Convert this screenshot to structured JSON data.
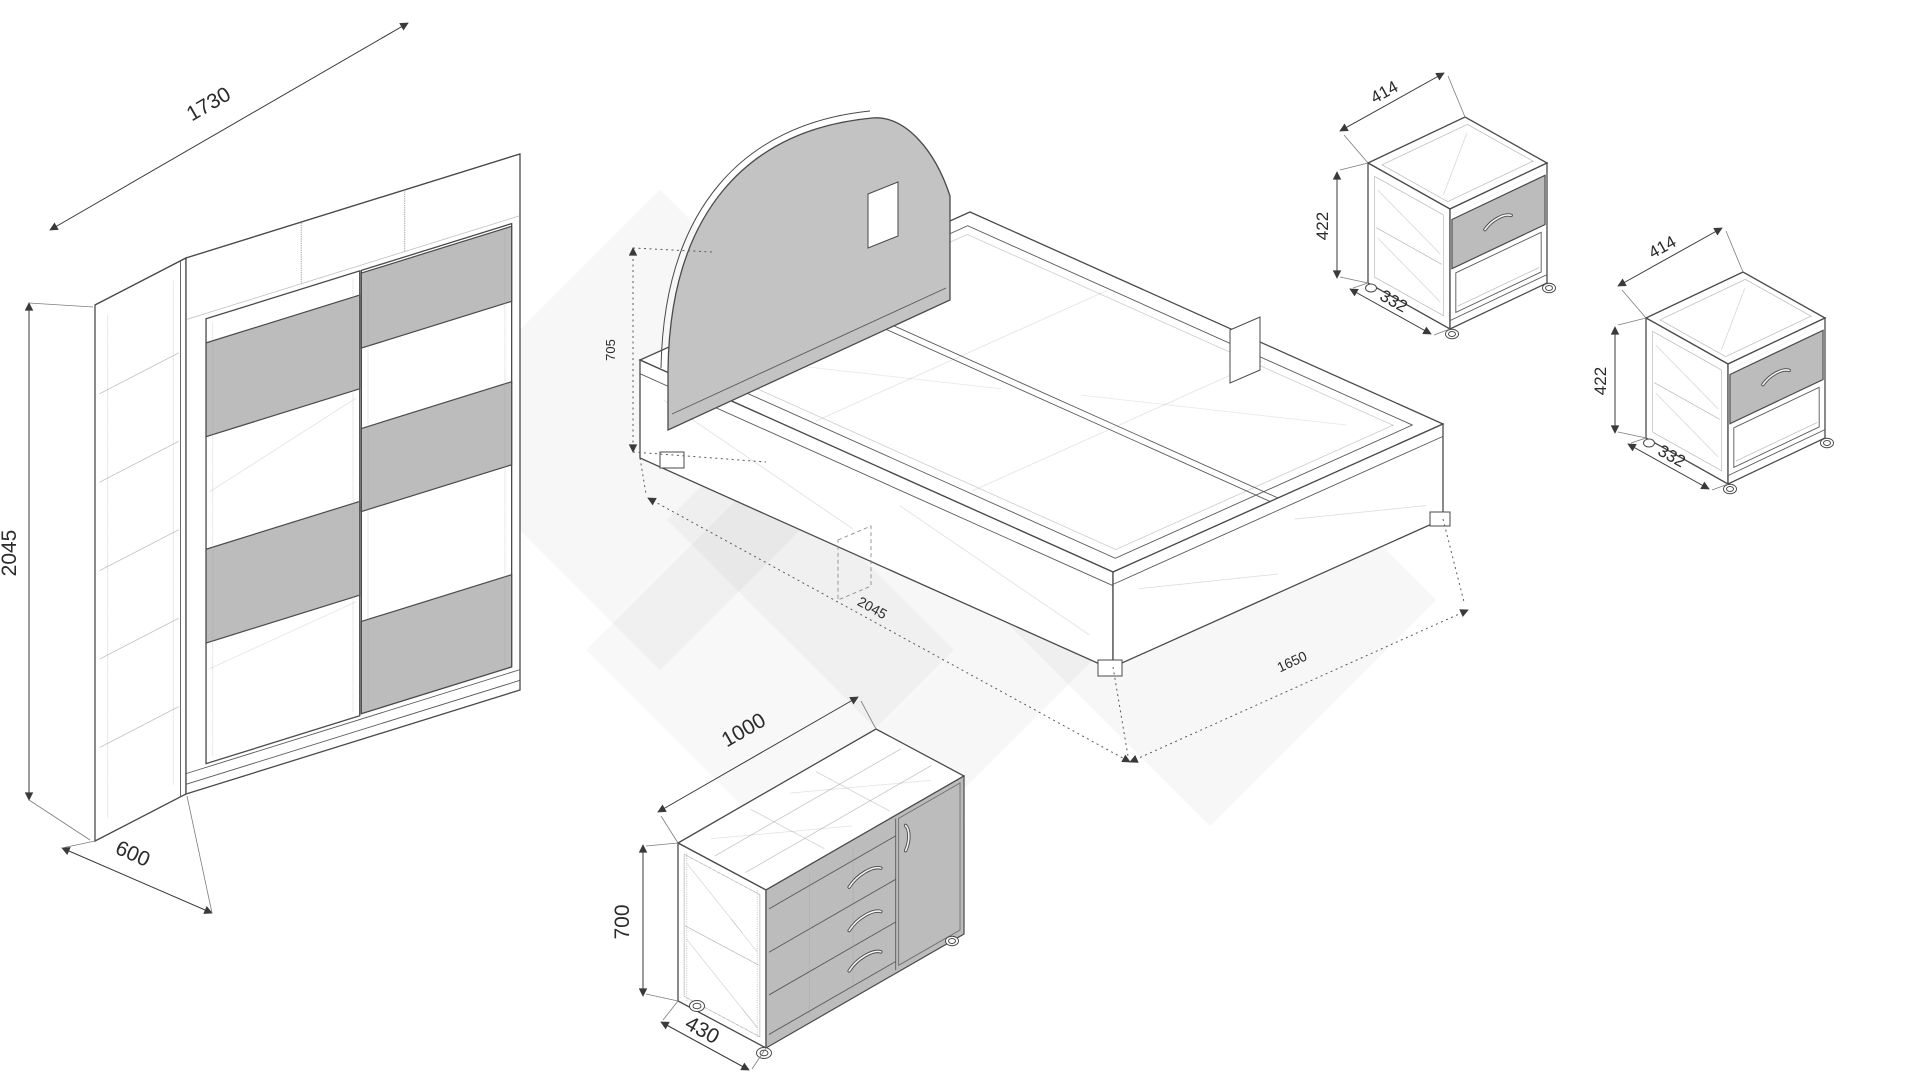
{
  "colors": {
    "outline": "#4a4a4a",
    "panel_gray": "#bcbcbc",
    "dim_text": "#2b2b2b",
    "background": "#ffffff"
  },
  "wardrobe": {
    "width_label": "1730",
    "height_label": "2045",
    "depth_label": "600"
  },
  "bed": {
    "height_label": "705",
    "length_label": "2045",
    "width_label": "1650"
  },
  "nightstand_top": {
    "width_label": "414",
    "height_label": "422",
    "depth_label": "332"
  },
  "nightstand_right": {
    "width_label": "414",
    "height_label": "422",
    "depth_label": "332"
  },
  "dresser": {
    "width_label": "1000",
    "height_label": "700",
    "depth_label": "430"
  }
}
